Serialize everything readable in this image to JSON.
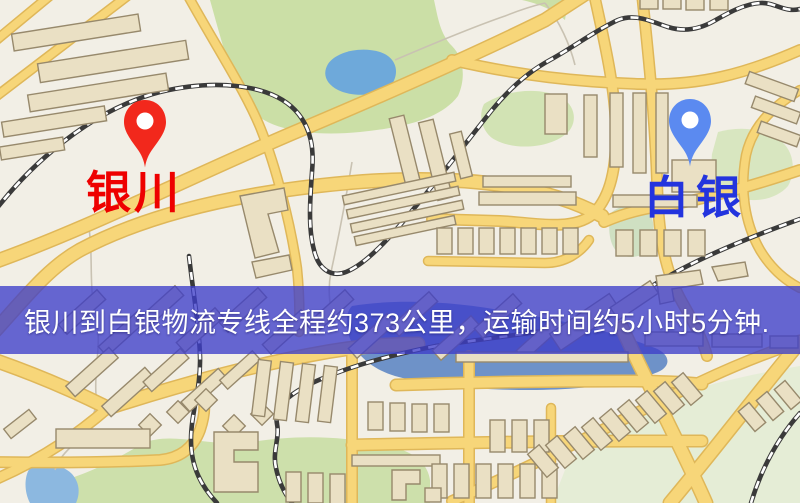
{
  "markers": {
    "origin": {
      "label": "银川",
      "label_color": "#ee0000",
      "pin_color": "#f2281c"
    },
    "destination": {
      "label": "白银",
      "label_color": "#2334de",
      "pin_color": "#5b8af0"
    }
  },
  "banner": {
    "text": "银川到白银物流专线全程约373公里，运输时间约5小时5分钟.",
    "background_color": "#3d3dc9",
    "text_color": "#ffffff",
    "distance": "约373公里",
    "duration": "约5小时5分钟"
  },
  "map": {
    "palette": {
      "background": "#f2efe6",
      "road_fill": "#f7d679",
      "road_casing": "#dfb759",
      "park_green": "#cbdfa6",
      "park_pale": "#e5edd6",
      "water_blue": "#6ea9da",
      "river_blue": "#5f87c4",
      "railway_dark": "#3a3a3a",
      "building_fill": "#eae0c4",
      "building_outline": "#97896c"
    }
  }
}
